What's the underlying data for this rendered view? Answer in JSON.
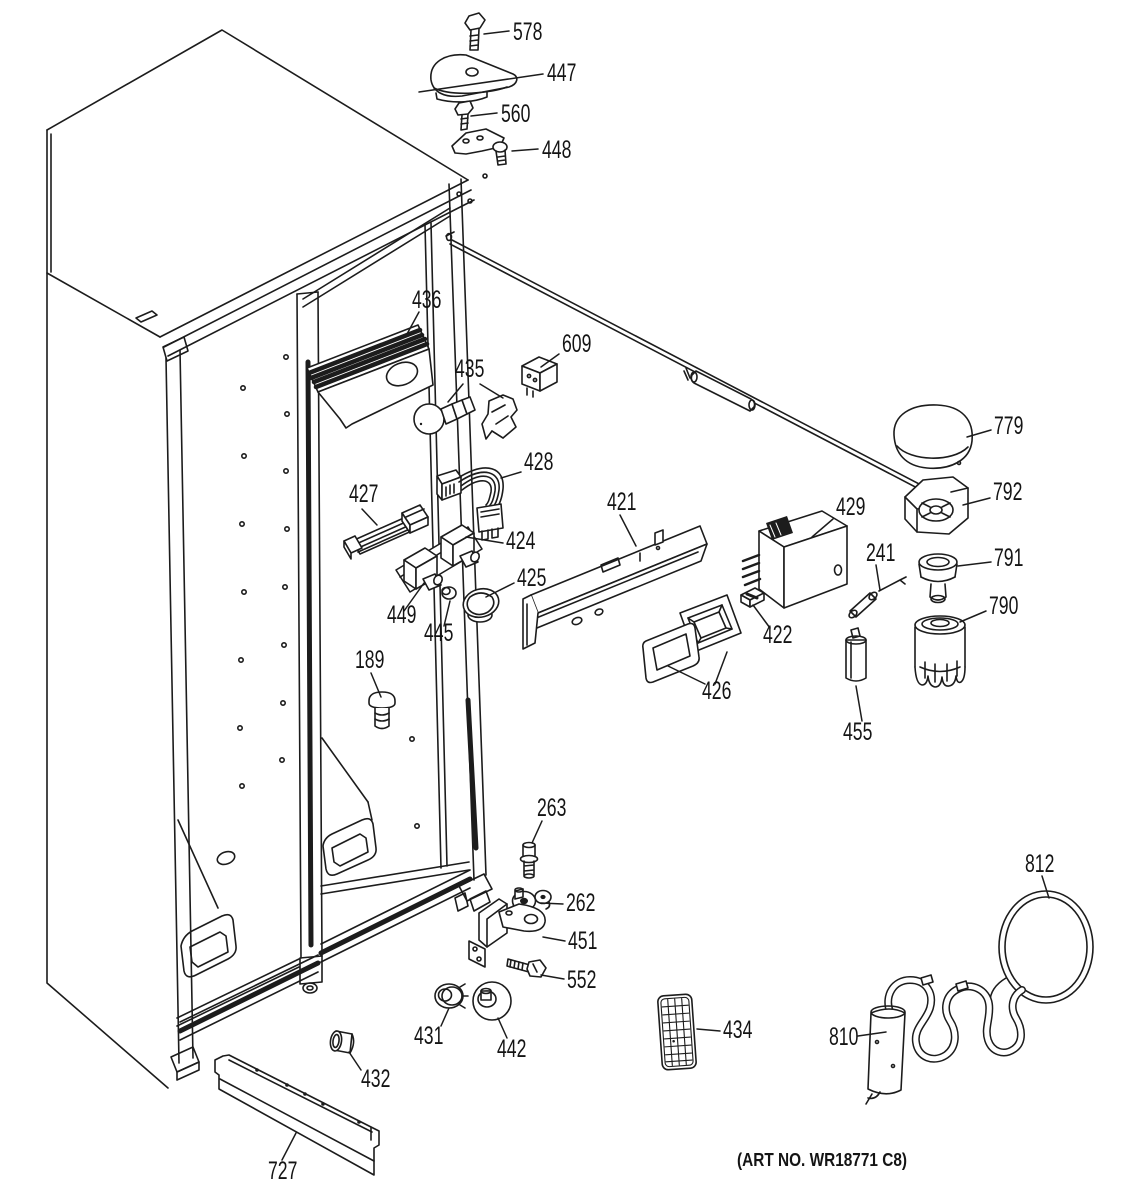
{
  "diagram": {
    "footer_note": "(ART NO. WR18771 C8)"
  },
  "part_labels": [
    {
      "text": "578",
      "x": 513,
      "y": 40,
      "leaders": [
        [
          509,
          31,
          484,
          34
        ]
      ]
    },
    {
      "text": "447",
      "x": 547,
      "y": 81,
      "leaders": [
        [
          543,
          74,
          419,
          92
        ]
      ]
    },
    {
      "text": "560",
      "x": 501,
      "y": 122,
      "leaders": [
        [
          497,
          113,
          471,
          116
        ]
      ]
    },
    {
      "text": "448",
      "x": 542,
      "y": 158,
      "leaders": [
        [
          538,
          149,
          512,
          151
        ]
      ]
    },
    {
      "text": "436",
      "x": 412,
      "y": 308,
      "leaders": [
        [
          419,
          312,
          407,
          334
        ]
      ]
    },
    {
      "text": "609",
      "x": 562,
      "y": 352,
      "leaders": [
        [
          559,
          354,
          541,
          367
        ]
      ]
    },
    {
      "text": "435",
      "x": 455,
      "y": 377,
      "leaders": [
        [
          463,
          384,
          448,
          402
        ],
        [
          480,
          384,
          503,
          398
        ]
      ]
    },
    {
      "text": "428",
      "x": 524,
      "y": 470,
      "leaders": [
        [
          521,
          472,
          501,
          478
        ]
      ]
    },
    {
      "text": "427",
      "x": 349,
      "y": 502,
      "leaders": [
        [
          362,
          509,
          377,
          525
        ]
      ]
    },
    {
      "text": "424",
      "x": 506,
      "y": 549,
      "leaders": [
        [
          503,
          543,
          466,
          537
        ]
      ]
    },
    {
      "text": "421",
      "x": 607,
      "y": 510,
      "leaders": [
        [
          620,
          515,
          636,
          546
        ]
      ]
    },
    {
      "text": "429",
      "x": 836,
      "y": 515,
      "leaders": [
        [
          833,
          519,
          812,
          537
        ]
      ]
    },
    {
      "text": "241",
      "x": 866,
      "y": 561,
      "leaders": [
        [
          876,
          565,
          880,
          590
        ]
      ]
    },
    {
      "text": "779",
      "x": 994,
      "y": 434,
      "leaders": [
        [
          991,
          430,
          967,
          437
        ]
      ]
    },
    {
      "text": "792",
      "x": 993,
      "y": 500,
      "leaders": [
        [
          990,
          498,
          963,
          505
        ]
      ]
    },
    {
      "text": "791",
      "x": 994,
      "y": 566,
      "leaders": [
        [
          991,
          562,
          958,
          566
        ]
      ]
    },
    {
      "text": "790",
      "x": 989,
      "y": 614,
      "leaders": [
        [
          986,
          611,
          960,
          622
        ]
      ]
    },
    {
      "text": "425",
      "x": 517,
      "y": 586,
      "leaders": [
        [
          514,
          583,
          486,
          597
        ]
      ]
    },
    {
      "text": "449",
      "x": 387,
      "y": 623,
      "leaders": [
        [
          404,
          611,
          424,
          583
        ]
      ]
    },
    {
      "text": "445",
      "x": 424,
      "y": 641,
      "leaders": [
        [
          444,
          626,
          450,
          601
        ]
      ]
    },
    {
      "text": "422",
      "x": 763,
      "y": 643,
      "leaders": [
        [
          770,
          628,
          753,
          605
        ]
      ]
    },
    {
      "text": "426",
      "x": 702,
      "y": 699,
      "leaders": [
        [
          705,
          684,
          668,
          666
        ],
        [
          715,
          684,
          727,
          652
        ]
      ]
    },
    {
      "text": "455",
      "x": 843,
      "y": 740,
      "leaders": [
        [
          862,
          721,
          856,
          686
        ]
      ]
    },
    {
      "text": "189",
      "x": 355,
      "y": 668,
      "leaders": [
        [
          371,
          673,
          381,
          697
        ]
      ]
    },
    {
      "text": "263",
      "x": 537,
      "y": 816,
      "leaders": [
        [
          542,
          821,
          532,
          843
        ]
      ]
    },
    {
      "text": "262",
      "x": 566,
      "y": 911,
      "leaders": [
        [
          563,
          904,
          541,
          903
        ]
      ]
    },
    {
      "text": "451",
      "x": 568,
      "y": 949,
      "leaders": [
        [
          565,
          941,
          543,
          937
        ]
      ]
    },
    {
      "text": "552",
      "x": 567,
      "y": 988,
      "leaders": [
        [
          564,
          979,
          541,
          975
        ]
      ]
    },
    {
      "text": "431",
      "x": 414,
      "y": 1044,
      "leaders": [
        [
          441,
          1026,
          449,
          1008
        ]
      ]
    },
    {
      "text": "442",
      "x": 497,
      "y": 1057,
      "leaders": [
        [
          507,
          1038,
          498,
          1018
        ]
      ]
    },
    {
      "text": "432",
      "x": 361,
      "y": 1087,
      "leaders": [
        [
          361,
          1070,
          349,
          1052
        ]
      ]
    },
    {
      "text": "434",
      "x": 723,
      "y": 1038,
      "leaders": [
        [
          720,
          1031,
          697,
          1029
        ]
      ]
    },
    {
      "text": "812",
      "x": 1025,
      "y": 872,
      "leaders": [
        [
          1042,
          876,
          1049,
          898
        ]
      ]
    },
    {
      "text": "810",
      "x": 829,
      "y": 1045,
      "leaders": [
        [
          858,
          1036,
          886,
          1032
        ]
      ]
    },
    {
      "text": "727",
      "x": 268,
      "y": 1179,
      "leaders": [
        [
          282,
          1160,
          296,
          1133
        ]
      ]
    }
  ]
}
